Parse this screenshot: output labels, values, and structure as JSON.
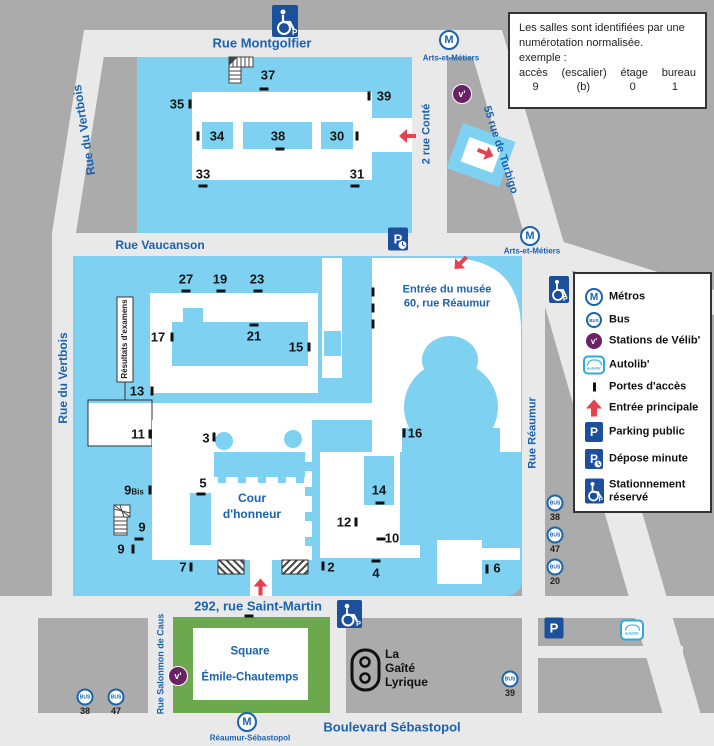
{
  "streets": {
    "montgolfier": "Rue Montgolfier",
    "vertbois": "Rue du Vertbois",
    "vaucanson": "Rue Vaucanson",
    "conte": "2 rue Conté",
    "turbigo": "55 rue de Turbigo",
    "reaumur": "Rue Réaumur",
    "saint_martin": "292, rue Saint-Martin",
    "salomon": "Rue Salonmon de Caus",
    "sebastopol": "Boulevard Sébastopol"
  },
  "metro": {
    "letter": "M",
    "stations": [
      "Arts-et-Métiers",
      "Arts-et-Métiers",
      "Réaumur-Sébastopol"
    ]
  },
  "bus": {
    "label": "BUS",
    "stops": [
      "38",
      "47",
      "20",
      "38",
      "47",
      "39"
    ]
  },
  "velib": {
    "v": "v'"
  },
  "autolib": {
    "label": "autolib'"
  },
  "parking": {
    "p": "P"
  },
  "info_box": {
    "line1": "Les salles sont identifiées par une",
    "line2": "numérotation normalisée.",
    "line3": "exemple :",
    "columns": [
      "accès",
      "(escalier)",
      "étage",
      "bureau"
    ],
    "values": [
      "9",
      "(b)",
      "0",
      "1"
    ]
  },
  "legend": {
    "items": [
      {
        "label": "Métros",
        "label2": ""
      },
      {
        "label": "Bus",
        "label2": ""
      },
      {
        "label": "Stations de Vélib'",
        "label2": ""
      },
      {
        "label": "Autolib'",
        "label2": ""
      },
      {
        "label": "Portes d'accès",
        "label2": ""
      },
      {
        "label": "Entrée principale",
        "label2": ""
      },
      {
        "label": "Parking public",
        "label2": ""
      },
      {
        "label": "Dépose minute",
        "label2": ""
      },
      {
        "label": "Stationnement",
        "label2": "réservé"
      }
    ]
  },
  "map": {
    "musee_line1": "Entrée du musée",
    "musee_line2": "60, rue Réaumur",
    "cour_line1": "Cour",
    "cour_line2": "d'honneur",
    "resultats": "Résultats d'examens",
    "square_line1": "Square",
    "square_line2": "Émile-Chautemps",
    "gaite_line1": "La",
    "gaite_line2": "Gaîté",
    "gaite_line3": "Lyrique",
    "nine_bis": {
      "num": "9",
      "suffix": "Bis"
    },
    "access_points": [
      {
        "label": "37"
      },
      {
        "label": "35"
      },
      {
        "label": "39"
      },
      {
        "label": "34"
      },
      {
        "label": "38"
      },
      {
        "label": "30"
      },
      {
        "label": "33"
      },
      {
        "label": "31"
      },
      {
        "label": "27"
      },
      {
        "label": "19"
      },
      {
        "label": "23"
      },
      {
        "label": "17"
      },
      {
        "label": "21"
      },
      {
        "label": "15"
      },
      {
        "label": "13"
      },
      {
        "label": "11"
      },
      {
        "label": "3"
      },
      {
        "label": "16"
      },
      {
        "label": "9"
      },
      {
        "label": "9"
      },
      {
        "label": "5"
      },
      {
        "label": "14"
      },
      {
        "label": "12"
      },
      {
        "label": "10"
      },
      {
        "label": "7"
      },
      {
        "label": "2"
      },
      {
        "label": "4"
      },
      {
        "label": "6"
      }
    ]
  },
  "colors": {
    "building_blue": "#7FD1F2",
    "street_gray": "#E9E9E9",
    "block_gray": "#ABABAB",
    "square_green": "#6CA94E",
    "label_blue": "#1A63B0",
    "icon_navy": "#1C4F9C",
    "arrow_red": "#E8414D",
    "velib_purple": "#6B2166"
  }
}
